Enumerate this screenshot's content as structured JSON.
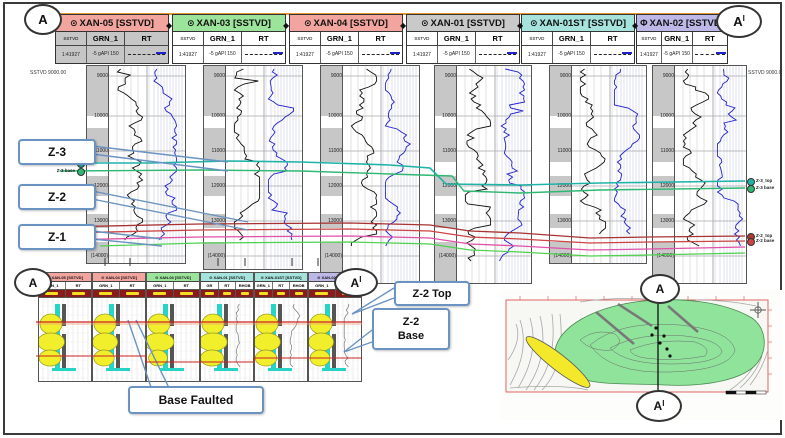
{
  "figure": {
    "endpoints": {
      "a": "A",
      "a_prime": "A",
      "prime_sup": "I"
    }
  },
  "section": {
    "left_scale": "SSTVD 9000.00",
    "right_scale": "SSTVD 9000.00",
    "wells": [
      {
        "icon": "⊙",
        "name": "XAN-05 [SSTVD]",
        "color": "#f2a49e",
        "body": "#c6c6c6",
        "cols": [
          "SSTVD",
          "GRN_1",
          "RT"
        ],
        "scale": "1:41927",
        "grn_scale": "-5 gAPI 150"
      },
      {
        "icon": "⊙",
        "name": "XAN-03 [SSTVD]",
        "color": "#9ce49c",
        "body": "#ffffff",
        "cols": [
          "SSTVD",
          "GRN_1",
          "RT"
        ],
        "scale": "1:41927",
        "grn_scale": "-5 gAPI 150"
      },
      {
        "icon": "⊙",
        "name": "XAN-04 [SSTVD]",
        "color": "#f2a49e",
        "body": "#ffffff",
        "cols": [
          "SSTVD",
          "GRN_1",
          "RT"
        ],
        "scale": "1:41927",
        "grn_scale": "-5 gAPI 150"
      },
      {
        "icon": "⊙",
        "name": "XAN-01 [SSTVD]",
        "color": "#c9c9c9",
        "body": "#ffffff",
        "cols": [
          "SSTVD",
          "GRN_1",
          "RT"
        ],
        "scale": "1:41927",
        "grn_scale": "-5 gAPI 150"
      },
      {
        "icon": "⊙",
        "name": "XAN-01ST [SSTVD]",
        "color": "#a6e3dc",
        "body": "#ffffff",
        "cols": [
          "SSTVD",
          "GRN_1",
          "RT"
        ],
        "scale": "1:41927",
        "grn_scale": "-5 gAPI 150"
      },
      {
        "icon": "Φ",
        "name": "XAN-02 [SSTVD]",
        "color": "#bcb8e8",
        "body": "#ffffff",
        "cols": [
          "SSTVD",
          "GRN_1",
          "RT"
        ],
        "scale": "1:41927",
        "grn_scale": "-5 gAPI 150"
      }
    ],
    "depth_ticks": [
      "9000",
      "10000",
      "11000",
      "12000",
      "13000",
      "(14000)"
    ],
    "markers_left": [
      {
        "label": "Z-3_top",
        "color": "#1fb3a8"
      },
      {
        "label": "Z-3 base",
        "color": "#2eb872"
      },
      {
        "label": "Z-2_top",
        "color": "#b03a2e"
      },
      {
        "label": "Z-2 base",
        "color": "#cc4444"
      },
      {
        "label": "Z-1_top",
        "color": "#e051a8"
      }
    ],
    "markers_right": [
      {
        "label": "Z-3_top",
        "color": "#1fb3a8"
      },
      {
        "label": "Z-3 base",
        "color": "#2eb872"
      },
      {
        "label": "Z-2_top",
        "color": "#b03a2e"
      },
      {
        "label": "Z-2 base",
        "color": "#cc4444"
      }
    ],
    "callouts": [
      {
        "label": "Z-3"
      },
      {
        "label": "Z-2"
      },
      {
        "label": "Z-1"
      }
    ],
    "line_colors": {
      "z3_top": "#1fb3a8",
      "z3_base": "#2eb872",
      "z2_top": "#a83232",
      "z2_base": "#cc4444",
      "z1_top": "#e051a8",
      "lower_green": "#4ed24e",
      "section_line": "#e8962e",
      "callout_border": "#6a93c2"
    }
  },
  "inset": {
    "a": "A",
    "a_prime": "A",
    "prime_sup": "I",
    "wells": [
      {
        "icon": "⊙",
        "name": "XAN-05 [SSTVD]",
        "color": "#f2a49e",
        "cols": [
          "GRN_1",
          "RT"
        ]
      },
      {
        "icon": "⊙",
        "name": "XAN-04 [SSTVD]",
        "color": "#f2a49e",
        "cols": [
          "GRN_1",
          "RT"
        ]
      },
      {
        "icon": "⊙",
        "name": "XAN-03 [SSTVD]",
        "color": "#9ce49c",
        "cols": [
          "GRN_1",
          "RT"
        ]
      },
      {
        "icon": "⊙",
        "name": "XAN-01 [SSTVD]",
        "color": "#a6e3dc",
        "cols": [
          "GR",
          "RT",
          "RHOB"
        ]
      },
      {
        "icon": "⊙",
        "name": "XAN-01ST [SSTVD]",
        "color": "#a6e3dc",
        "cols": [
          "GRN_1",
          "RT",
          "RHOB"
        ]
      },
      {
        "icon": "⊙",
        "name": "XAN-02 [SSTVD]",
        "color": "#bcb8e8",
        "cols": [
          "GRN_1",
          "RT"
        ]
      }
    ],
    "callouts": {
      "z2_top": "Z-2 Top",
      "z2_base_line1": "Z-2",
      "z2_base_line2": "Base",
      "base_faulted": "Base Faulted"
    }
  },
  "map": {
    "a": "A",
    "a_prime": "A",
    "prime_sup": "I",
    "colors": {
      "reservoir_fill": "#8fe39b",
      "oil_zone": "#f3e82a",
      "border": "#e06666"
    }
  }
}
